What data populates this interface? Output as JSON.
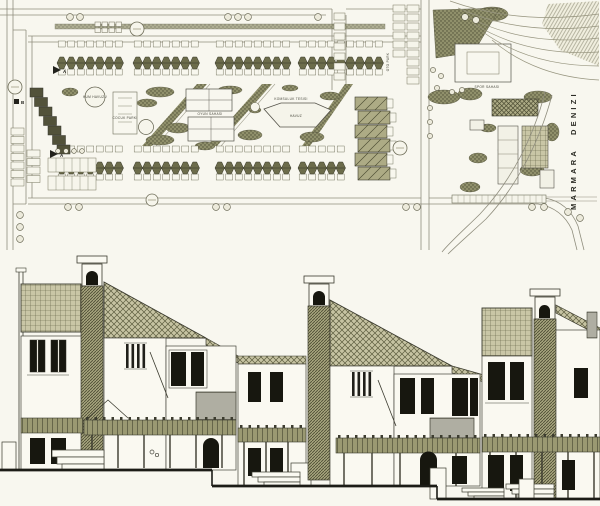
{
  "plan": {
    "sea_label_word1": "MARMARA",
    "sea_label_word2": "DENIZI",
    "labels": {
      "sand_pool": "KUM HAVUZU",
      "kids_park": "COCUK PARKI",
      "play_field": "OYUN SAHASI",
      "community_facility": "KOMSULUK TESISI",
      "pool": "HAVUZ",
      "sports_field": "SPOR SAHASI",
      "parking": "OTO PARK",
      "marker_a_north": "A",
      "marker_a_south": "A",
      "marker_b": "B"
    }
  }
}
